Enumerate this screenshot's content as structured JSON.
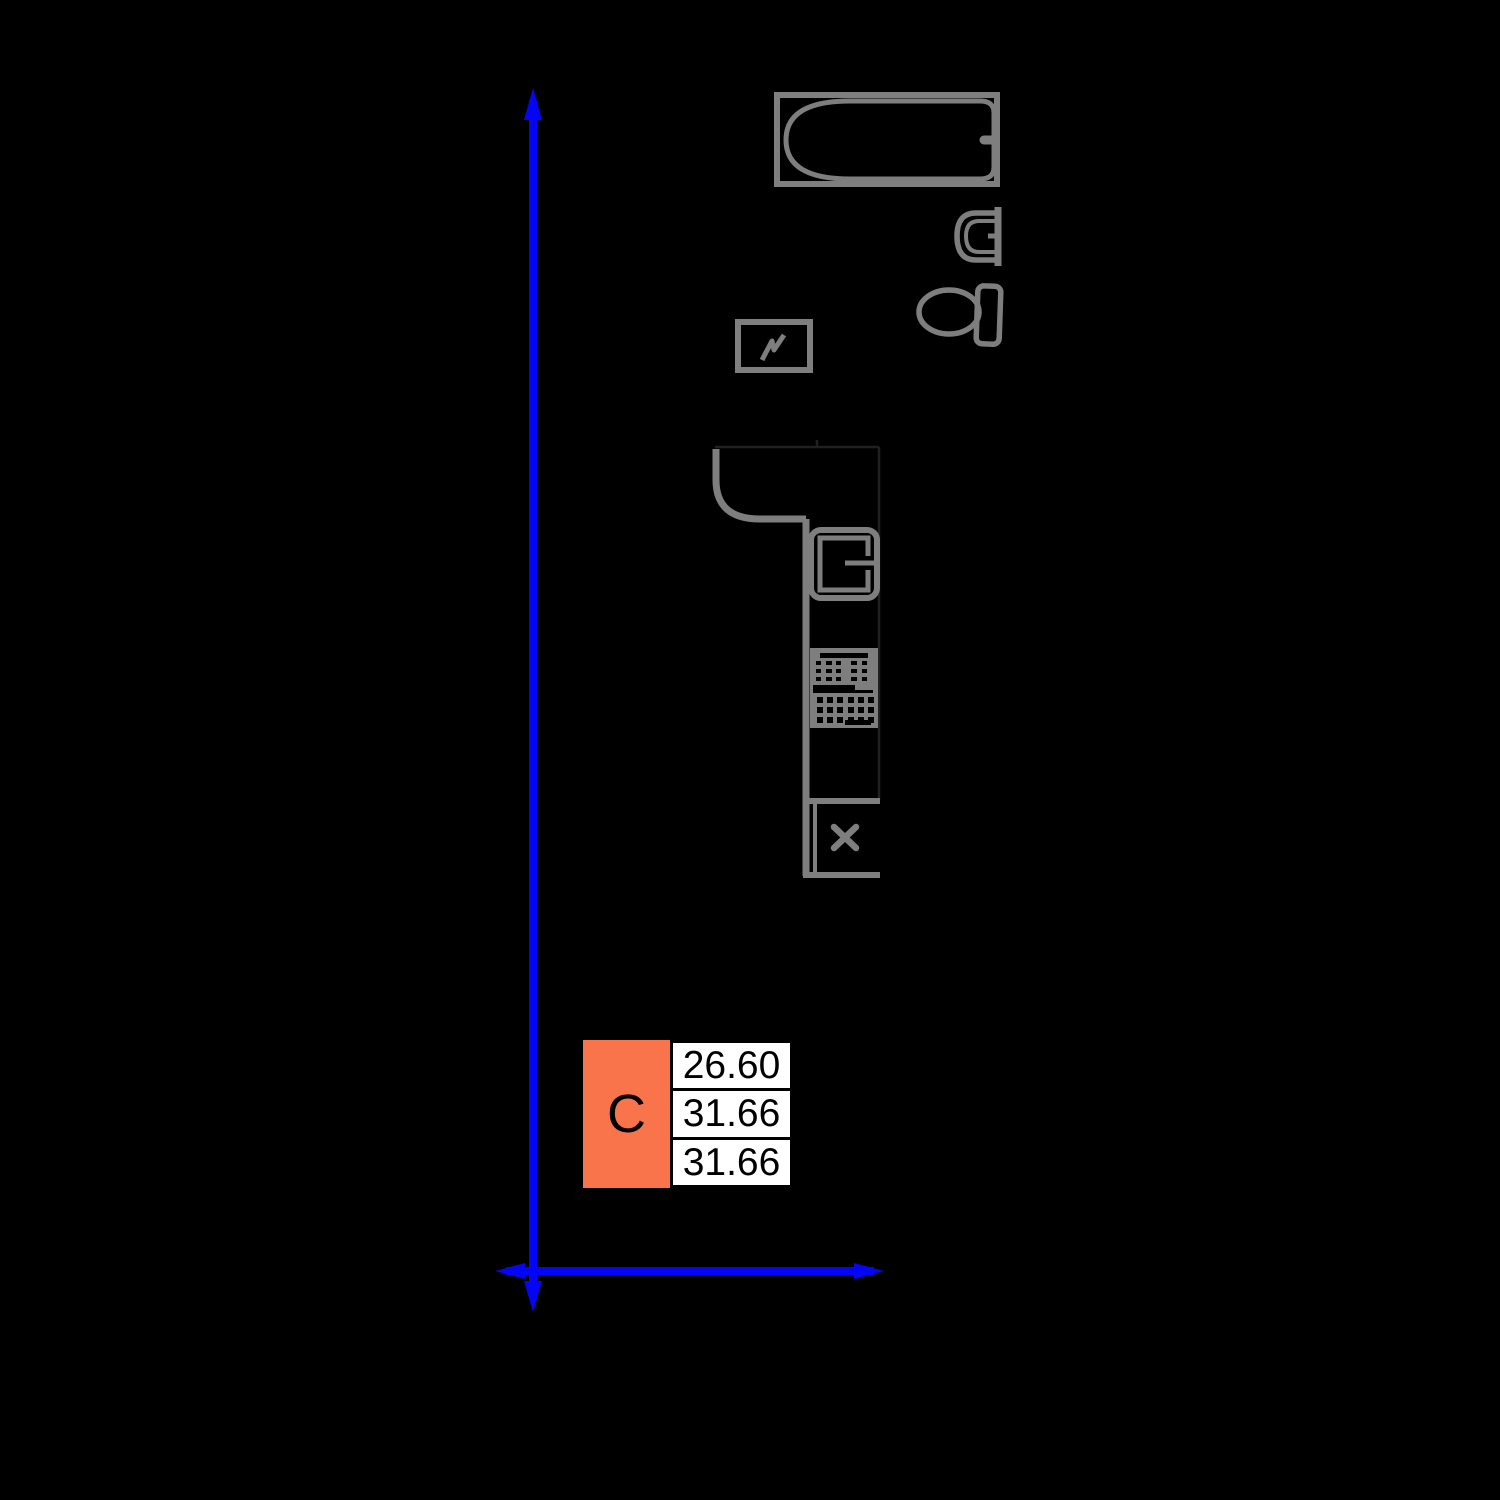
{
  "colors": {
    "background": "#000000",
    "axis_blue": "#0405f7",
    "fixture_gray": "#7e7e7e",
    "faint_wall_line": "#202020",
    "accent_orange": "#f9734b",
    "cell_background": "#ffffff",
    "text_black": "#000000"
  },
  "legend": {
    "unit_label": "C",
    "values": [
      "26.60",
      "31.66",
      "31.66"
    ]
  }
}
